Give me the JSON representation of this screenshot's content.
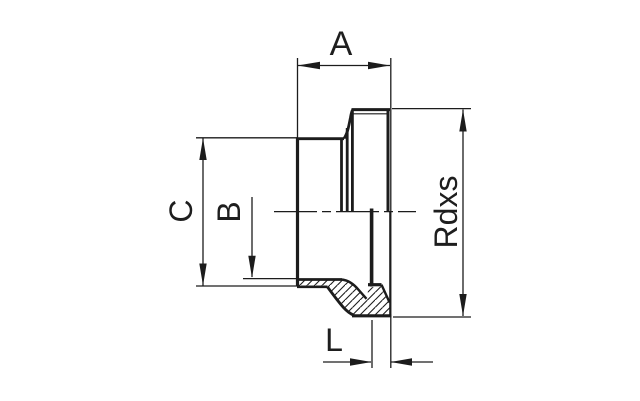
{
  "page": {
    "background_color": "#ffffff"
  },
  "drawing": {
    "type": "technical-dimension-drawing",
    "subject": "threaded-pipe-fitting-section",
    "line_color": "#1c1c1c",
    "text_color": "#1e1e1e",
    "hatch_style": "diagonal-45deg",
    "dimensions": [
      {
        "id": "length-a",
        "label": "A",
        "orientation": "horizontal",
        "position": "top",
        "arrow_style": "both-ends"
      },
      {
        "id": "diameter-c",
        "label": "C",
        "orientation": "vertical",
        "position": "left",
        "arrow_style": "both-ends"
      },
      {
        "id": "diameter-b",
        "label": "B",
        "orientation": "vertical",
        "position": "left",
        "arrow_style": "single-end"
      },
      {
        "id": "thread-size",
        "label": "Rdxs",
        "orientation": "vertical",
        "position": "right",
        "arrow_style": "both-ends"
      },
      {
        "id": "length-l",
        "label": "L",
        "orientation": "horizontal",
        "position": "bottom",
        "arrow_style": "outside-pointing-in"
      }
    ]
  }
}
